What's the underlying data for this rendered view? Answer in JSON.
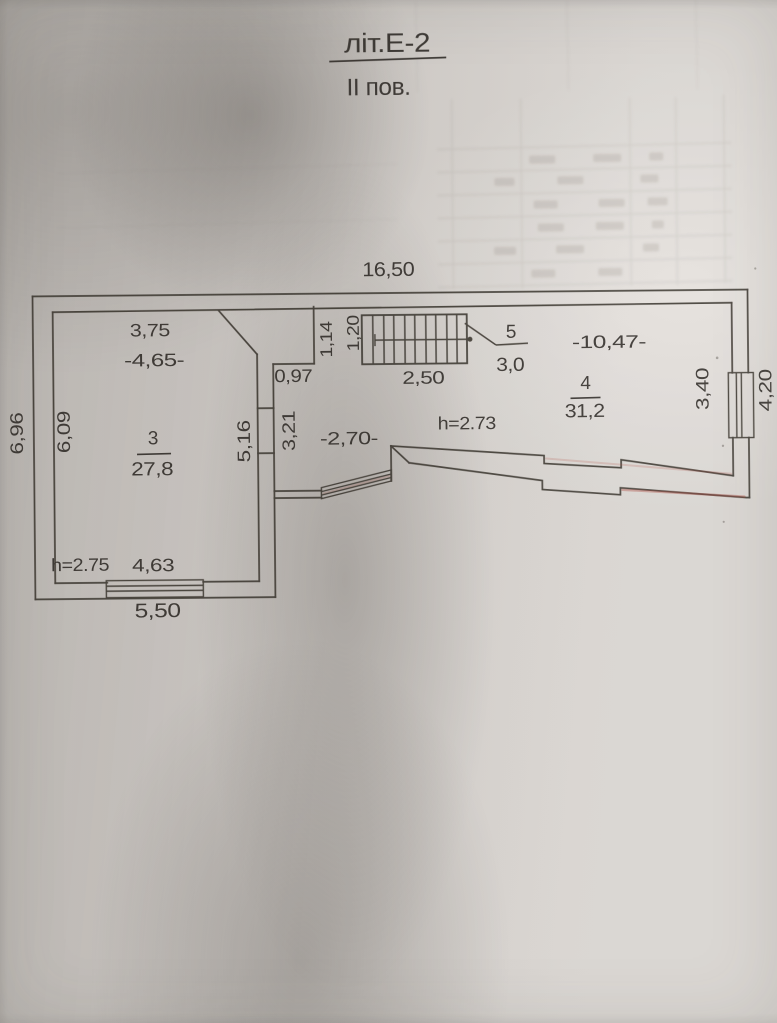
{
  "title": {
    "building": "літ.Е-2",
    "floor": "ІІ пов."
  },
  "overall": {
    "top_width": "16,50",
    "left_height": "6,96",
    "right_height": "4,20"
  },
  "room3": {
    "top_width": "3,75",
    "width_inner": "-4,65-",
    "left_height": "6,09",
    "number": "3",
    "area": "27,8",
    "right_height": "5,16",
    "ceiling_height": "h=2.75",
    "bottom_width_inner": "4,63",
    "bottom_width_outer": "5,50"
  },
  "hall": {
    "niche_width": "0,97",
    "depth": "3,21",
    "width": "-2,70-",
    "ceiling_height": "h=2.73"
  },
  "stairs": {
    "number": "5",
    "area": "3,0",
    "length": "2,50",
    "flight_width_a": "1,14",
    "flight_width_b": "1,20"
  },
  "room4": {
    "number": "4",
    "area": "31,2",
    "width": "-10,47-",
    "right_height": "3,40"
  }
}
